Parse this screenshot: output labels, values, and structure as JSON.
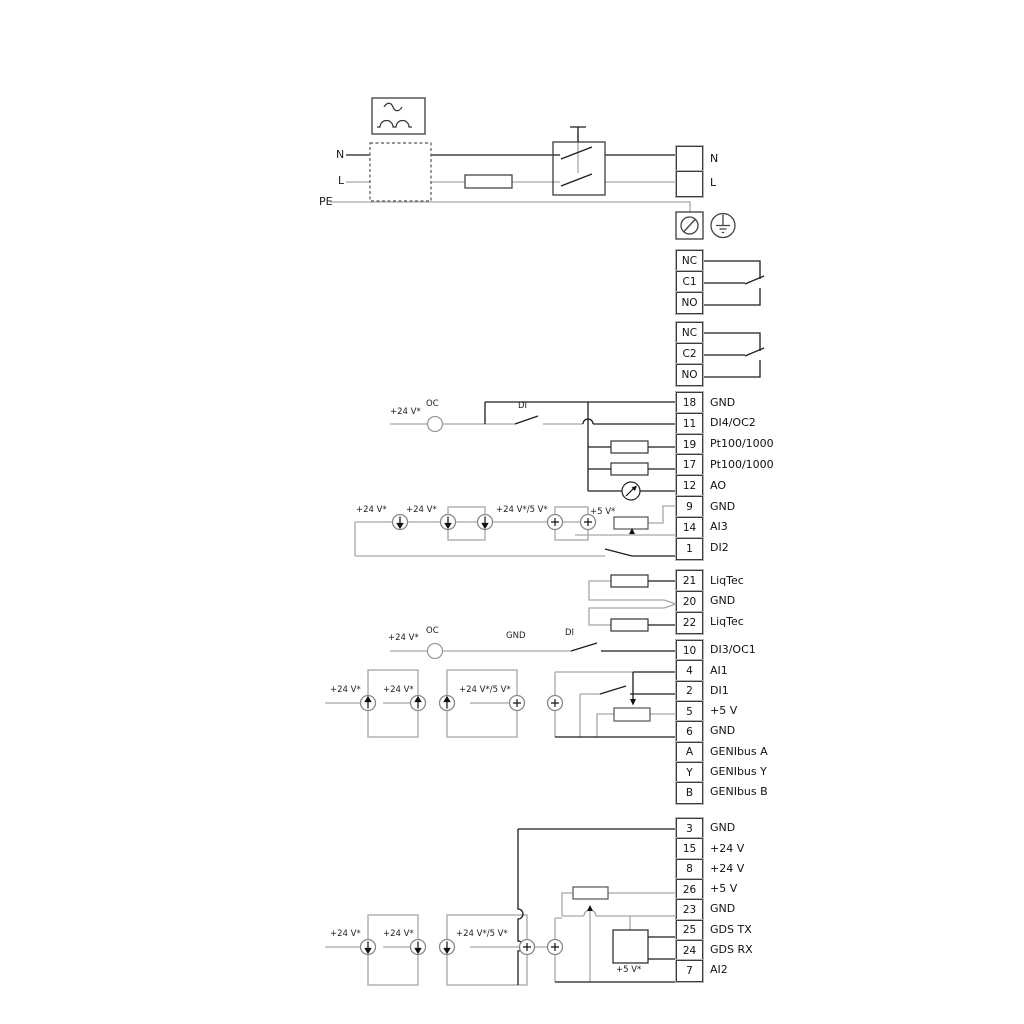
{
  "diagram_title": "pump-wiring-terminal-diagram",
  "power": {
    "n_left": "N",
    "l_left": "L",
    "pe_left": "PE",
    "n_right": "N",
    "l_right": "L"
  },
  "labels": {
    "v24": "+24 V*",
    "v24_5": "+24 V*/5 V*",
    "v5": "+5 V*",
    "oc": "OC",
    "di": "DI",
    "gnd": "GND"
  },
  "terminal_groups": {
    "nl": {
      "rows": [
        {
          "n": "",
          "label": "N"
        },
        {
          "n": "",
          "label": "L"
        }
      ]
    },
    "relay1": {
      "rows": [
        {
          "n": "NC",
          "label": ""
        },
        {
          "n": "C1",
          "label": ""
        },
        {
          "n": "NO",
          "label": ""
        }
      ]
    },
    "relay2": {
      "rows": [
        {
          "n": "NC",
          "label": ""
        },
        {
          "n": "C2",
          "label": ""
        },
        {
          "n": "NO",
          "label": ""
        }
      ]
    },
    "io1": {
      "rows": [
        {
          "n": "18",
          "label": "GND"
        },
        {
          "n": "11",
          "label": "DI4/OC2"
        },
        {
          "n": "19",
          "label": "Pt100/1000"
        },
        {
          "n": "17",
          "label": "Pt100/1000"
        },
        {
          "n": "12",
          "label": "AO"
        },
        {
          "n": "9",
          "label": "GND"
        },
        {
          "n": "14",
          "label": "AI3"
        },
        {
          "n": "1",
          "label": "DI2"
        }
      ]
    },
    "liqtec": {
      "rows": [
        {
          "n": "21",
          "label": "LiqTec"
        },
        {
          "n": "20",
          "label": "GND"
        },
        {
          "n": "22",
          "label": "LiqTec"
        }
      ]
    },
    "io2": {
      "rows": [
        {
          "n": "10",
          "label": "DI3/OC1"
        },
        {
          "n": "4",
          "label": "AI1"
        },
        {
          "n": "2",
          "label": "DI1"
        },
        {
          "n": "5",
          "label": "+5 V"
        },
        {
          "n": "6",
          "label": "GND"
        },
        {
          "n": "A",
          "label": "GENIbus A"
        },
        {
          "n": "Y",
          "label": "GENIbus Y"
        },
        {
          "n": "B",
          "label": "GENIbus B"
        }
      ]
    },
    "io3": {
      "rows": [
        {
          "n": "3",
          "label": "GND"
        },
        {
          "n": "15",
          "label": "+24 V"
        },
        {
          "n": "8",
          "label": "+24 V"
        },
        {
          "n": "26",
          "label": "+5 V"
        },
        {
          "n": "23",
          "label": "GND"
        },
        {
          "n": "25",
          "label": "GDS TX"
        },
        {
          "n": "24",
          "label": "GDS RX"
        },
        {
          "n": "7",
          "label": "AI2"
        }
      ]
    }
  },
  "colors": {
    "wire_dark": "#1c1c1c",
    "wire_gray": "#a6a6a6",
    "border": "#3c3c3c"
  }
}
